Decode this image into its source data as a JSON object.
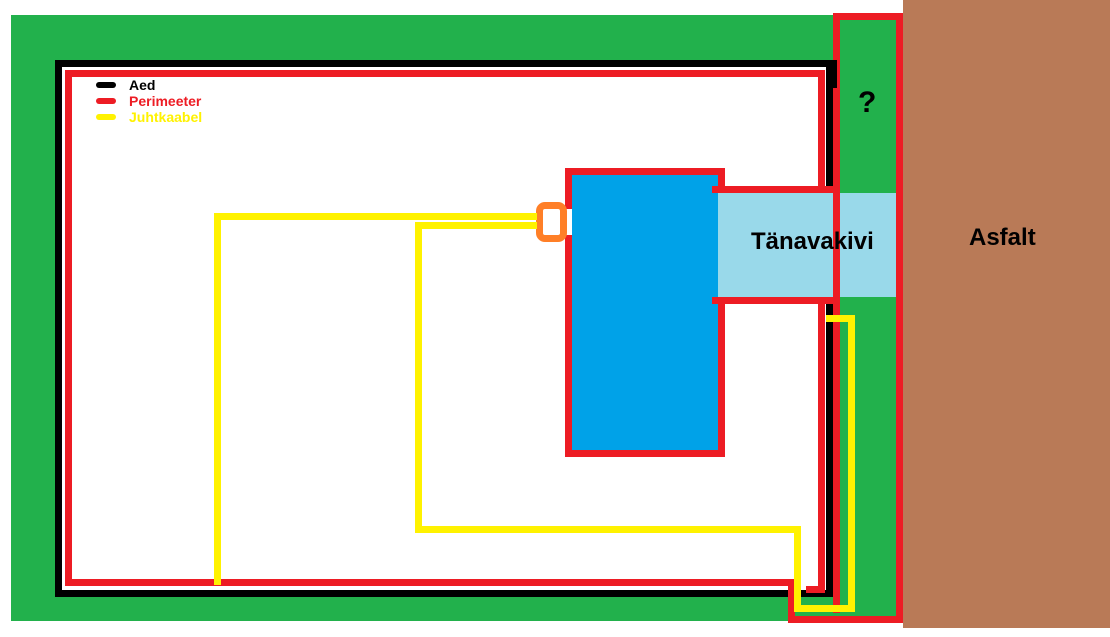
{
  "legend": {
    "items": [
      {
        "label": "Aed",
        "color": "#000000"
      },
      {
        "label": "Perimeeter",
        "color": "#ED1C24"
      },
      {
        "label": "Juhtkaabel",
        "color": "#FFF200"
      }
    ]
  },
  "regions": {
    "paving_label": "Tänavakivi",
    "asphalt_label": "Asfalt",
    "unknown_area_label": "?"
  },
  "colors": {
    "lawn_green": "#22B14C",
    "asphalt_brown": "#B97A57",
    "paving_light_blue": "#99D9EA",
    "building_blue": "#00A2E8",
    "fence_black": "#000000",
    "perimeter_red": "#ED1C24",
    "guide_cable_yellow": "#FFF200",
    "connector_orange": "#FF7F27",
    "background_white": "#FFFFFF"
  }
}
